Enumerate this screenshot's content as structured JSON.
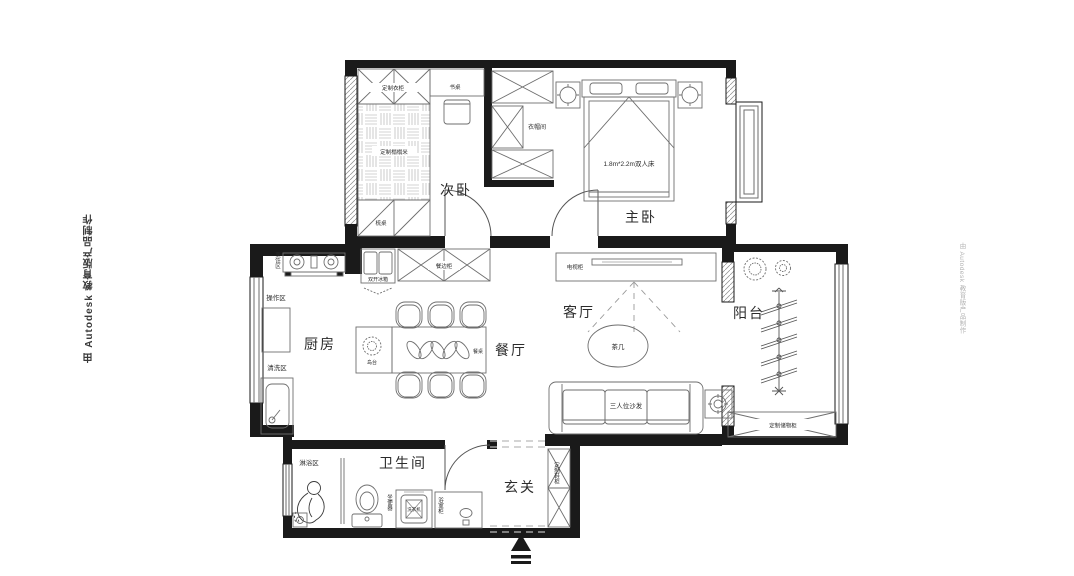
{
  "watermark": {
    "left": "由 Autodesk 教育版产品制作",
    "right": "由 Autodesk 教育版产品制作"
  },
  "rooms": {
    "secondary_bedroom": "次卧",
    "master_bedroom": "主卧",
    "cloakroom": "衣帽间",
    "kitchen": "厨房",
    "dining_room": "餐厅",
    "living_room": "客厅",
    "balcony": "阳台",
    "bathroom": "卫生间",
    "entry": "玄关"
  },
  "labels": {
    "custom_wardrobe": "定制衣柜",
    "desk": "书桌",
    "custom_tatami": "定制榻榻米",
    "dresser": "梳桌",
    "double_fridge": "双开冰箱",
    "sideboard": "餐边柜",
    "dining_table": "餐桌",
    "island": "岛台",
    "tv_cabinet": "电视柜",
    "tea_table": "茶几",
    "sofa": "三人位沙发",
    "double_bed": "1.8m*2.2m双人床",
    "cooking_zone": "烹饪区",
    "prep_zone": "操作区",
    "washing_zone": "清洗区",
    "shower_zone": "淋浴区",
    "toilet": "坐便器",
    "washing_machine": "洗衣机",
    "bathroom_cabinet": "浴室柜",
    "custom_shoe_cabinet": "定制鞋柜",
    "custom_storage_cabinet": "定制储物柜"
  },
  "colors": {
    "wall": "#1a1a1a",
    "furniture_line": "#6e6e6e",
    "dash_line": "#9a9a9a",
    "background": "#ffffff",
    "watermark_left": "#3a3a3a",
    "watermark_right": "#b3b3b3"
  }
}
